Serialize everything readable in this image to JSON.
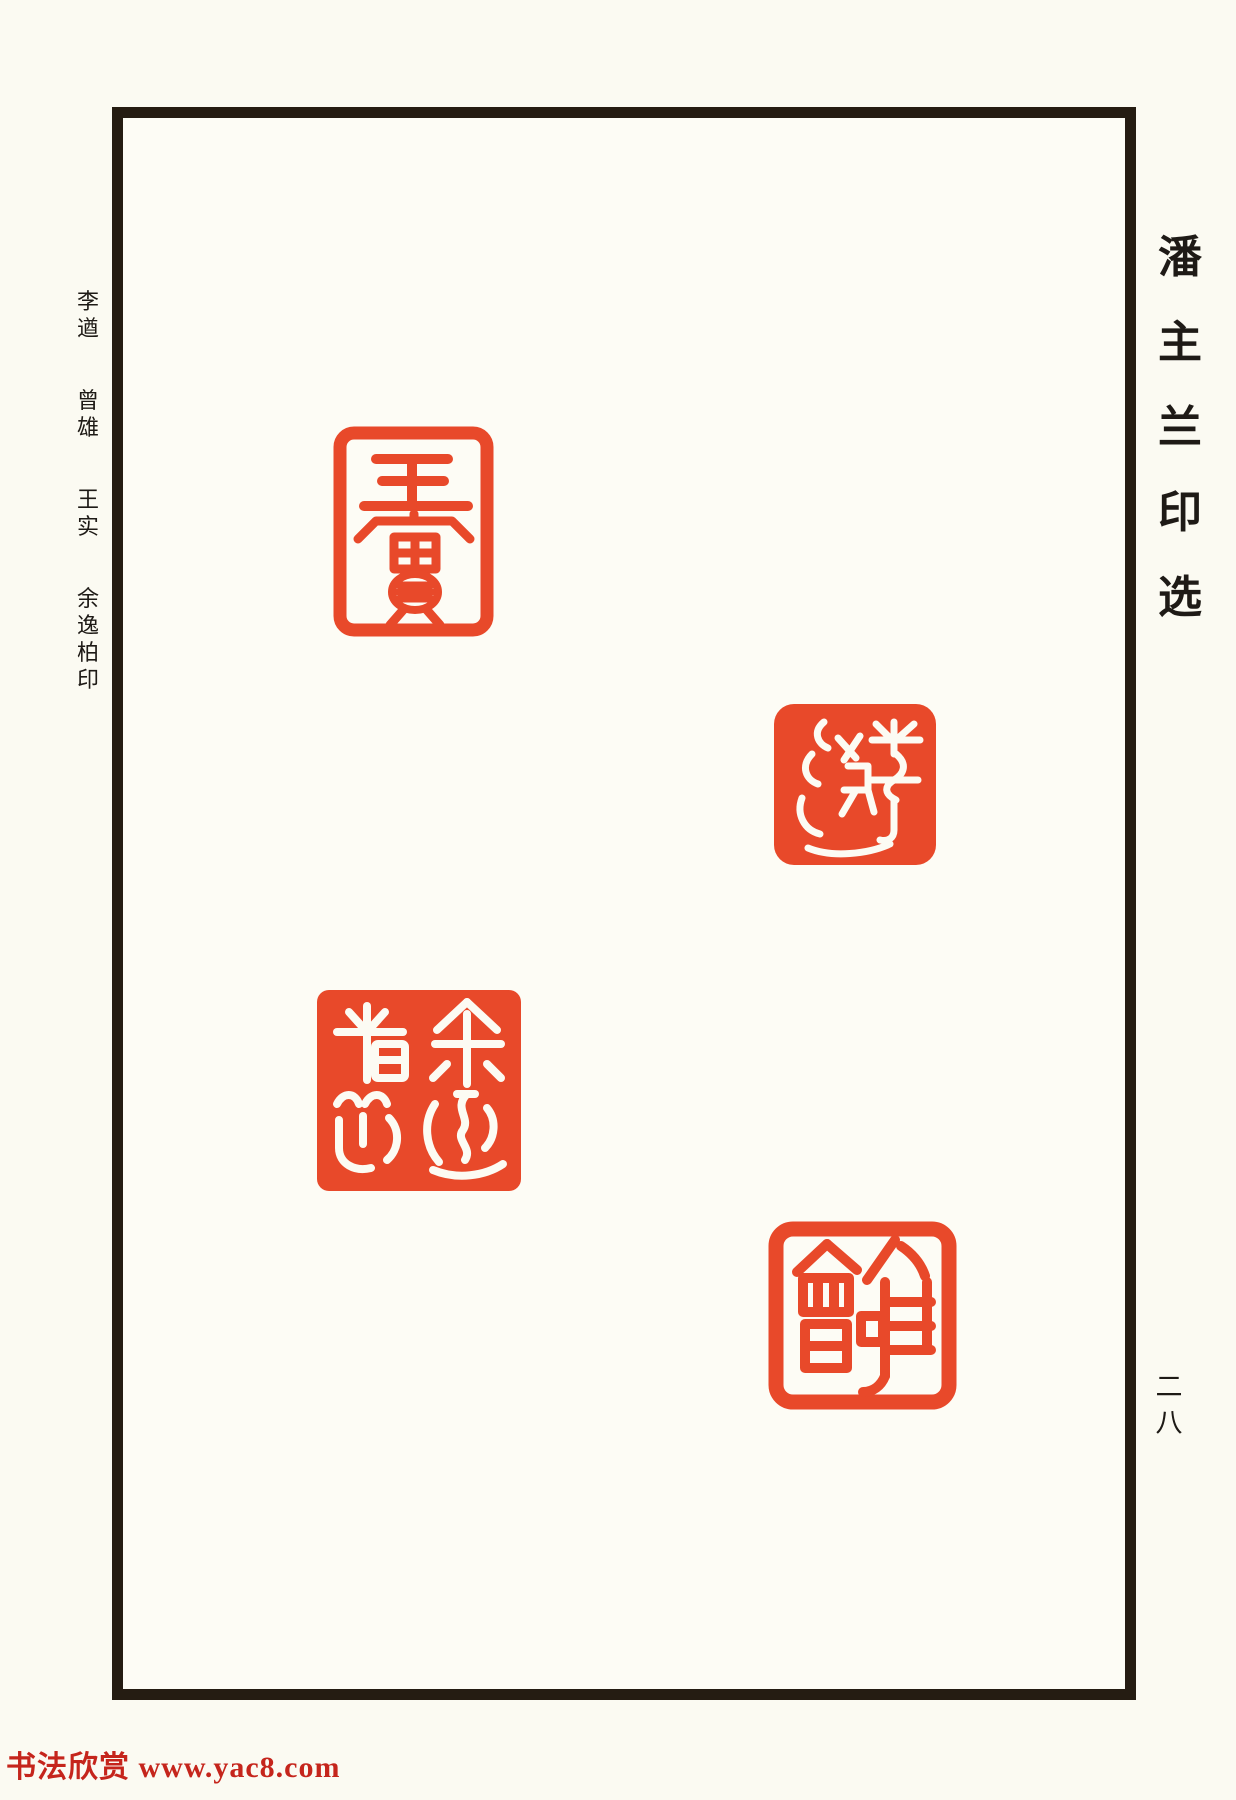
{
  "colors": {
    "paper": "#fbfaf2",
    "frame_black": "#251c12",
    "text_black": "#1e1a16",
    "seal_red": "#e8492a",
    "watermark_red": "#c5251c"
  },
  "right_title": {
    "text": "潘主兰印选",
    "chars": [
      "潘",
      "主",
      "兰",
      "印",
      "选"
    ]
  },
  "left_caption": {
    "text": "李遒 曾雄 王实 余逸柏印",
    "groups": [
      [
        "李",
        "遒"
      ],
      [
        "曾",
        "雄"
      ],
      [
        "王",
        "实"
      ],
      [
        "余",
        "逸",
        "柏",
        "印"
      ]
    ]
  },
  "page_number": {
    "text": "二八",
    "chars": [
      "二",
      "八"
    ]
  },
  "watermark": {
    "text": "书法欣赏 www.yac8.com"
  },
  "seals": [
    {
      "legend": "王实",
      "carved_text": "王實",
      "style": "zhuwen (red characters and red outline on white ground)",
      "shape": "vertical rectangle"
    },
    {
      "legend": "李遒",
      "carved_text": "李遒",
      "style": "baiwen (white characters on solid red ground)",
      "shape": "rounded square"
    },
    {
      "legend": "余逸柏印",
      "carved_text": "余逸柏印",
      "style": "baiwen (white characters on solid red ground)",
      "shape": "square"
    },
    {
      "legend": "曾雄",
      "carved_text": "曾雄",
      "style": "zhuwen (red characters with thick rough red border on white ground)",
      "shape": "square"
    }
  ]
}
